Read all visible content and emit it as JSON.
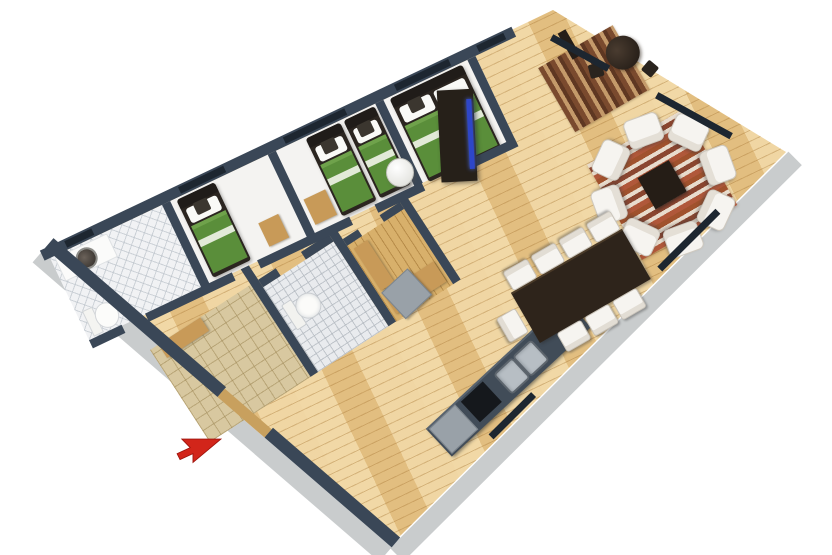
{
  "scene": {
    "kind": "3d-floorplan-isometric-render",
    "background_color": "#ffffff",
    "width": 832,
    "height": 555
  },
  "cursor": {
    "icon": "red-arrow-pointer",
    "direction": "north-east",
    "color": "#d2251a",
    "x": 176,
    "y": 438
  },
  "palette": {
    "wall_top": "#3a4757",
    "window_band": "#1d2630",
    "wall_outer_face": "#c9cccd",
    "wood_floor": "#e9c98d",
    "bath_tile": "#f1f2f4",
    "entry_tile": "#d8c8a0",
    "sauna_wood": "#d8b06b",
    "bedroom_floor": "#f4f3f1",
    "bed_green": "#5a8e3a",
    "bed_frame": "#2b2520",
    "pillow_white": "#fafaf7",
    "armchair_white": "#f6f4f0",
    "table_dark": "#2e241b",
    "tv_screen_blue": "#2e46c8",
    "counter_dark": "#414c58",
    "steel": "#b7bec4",
    "fridge_gray": "#99a1a8",
    "rug_red": "#b0583a",
    "rug_cream": "#e8dccd"
  },
  "rooms": {
    "bathroom_main": {
      "fixtures": [
        "washbasin",
        "toilet"
      ],
      "floor": "white-diamond-tile"
    },
    "bedroom_single": {
      "single_beds": 1,
      "chair": 1
    },
    "bedroom_twin": {
      "single_beds": 2,
      "bench": 1
    },
    "bedroom_master": {
      "double_beds": 1
    },
    "living_room": {
      "armchairs": 8,
      "coffee_table": 1,
      "tv_cabinet": 1,
      "rug": "red-striped"
    },
    "entry_hall": {
      "round_table": 1,
      "dark_chairs": 2,
      "runner_rug": "brown-striped",
      "coat_rack": 1
    },
    "hallway": {
      "water_heater": 1,
      "floor": "light-wood"
    },
    "lower_hall": {
      "floor": "beige-tile",
      "bench": 1,
      "entry_door": 1
    },
    "bathroom_second": {
      "fixtures": [
        "toilet"
      ],
      "floor": "gray-tile"
    },
    "sauna": {
      "benches": 2,
      "floor": "wood"
    },
    "kitchen": {
      "appliances": [
        "refrigerator",
        "stove",
        "double_sink"
      ],
      "island": 1
    },
    "dining": {
      "table": 1,
      "chairs_top": 4,
      "chairs_bottom": 3,
      "chairs_end": 1
    }
  }
}
